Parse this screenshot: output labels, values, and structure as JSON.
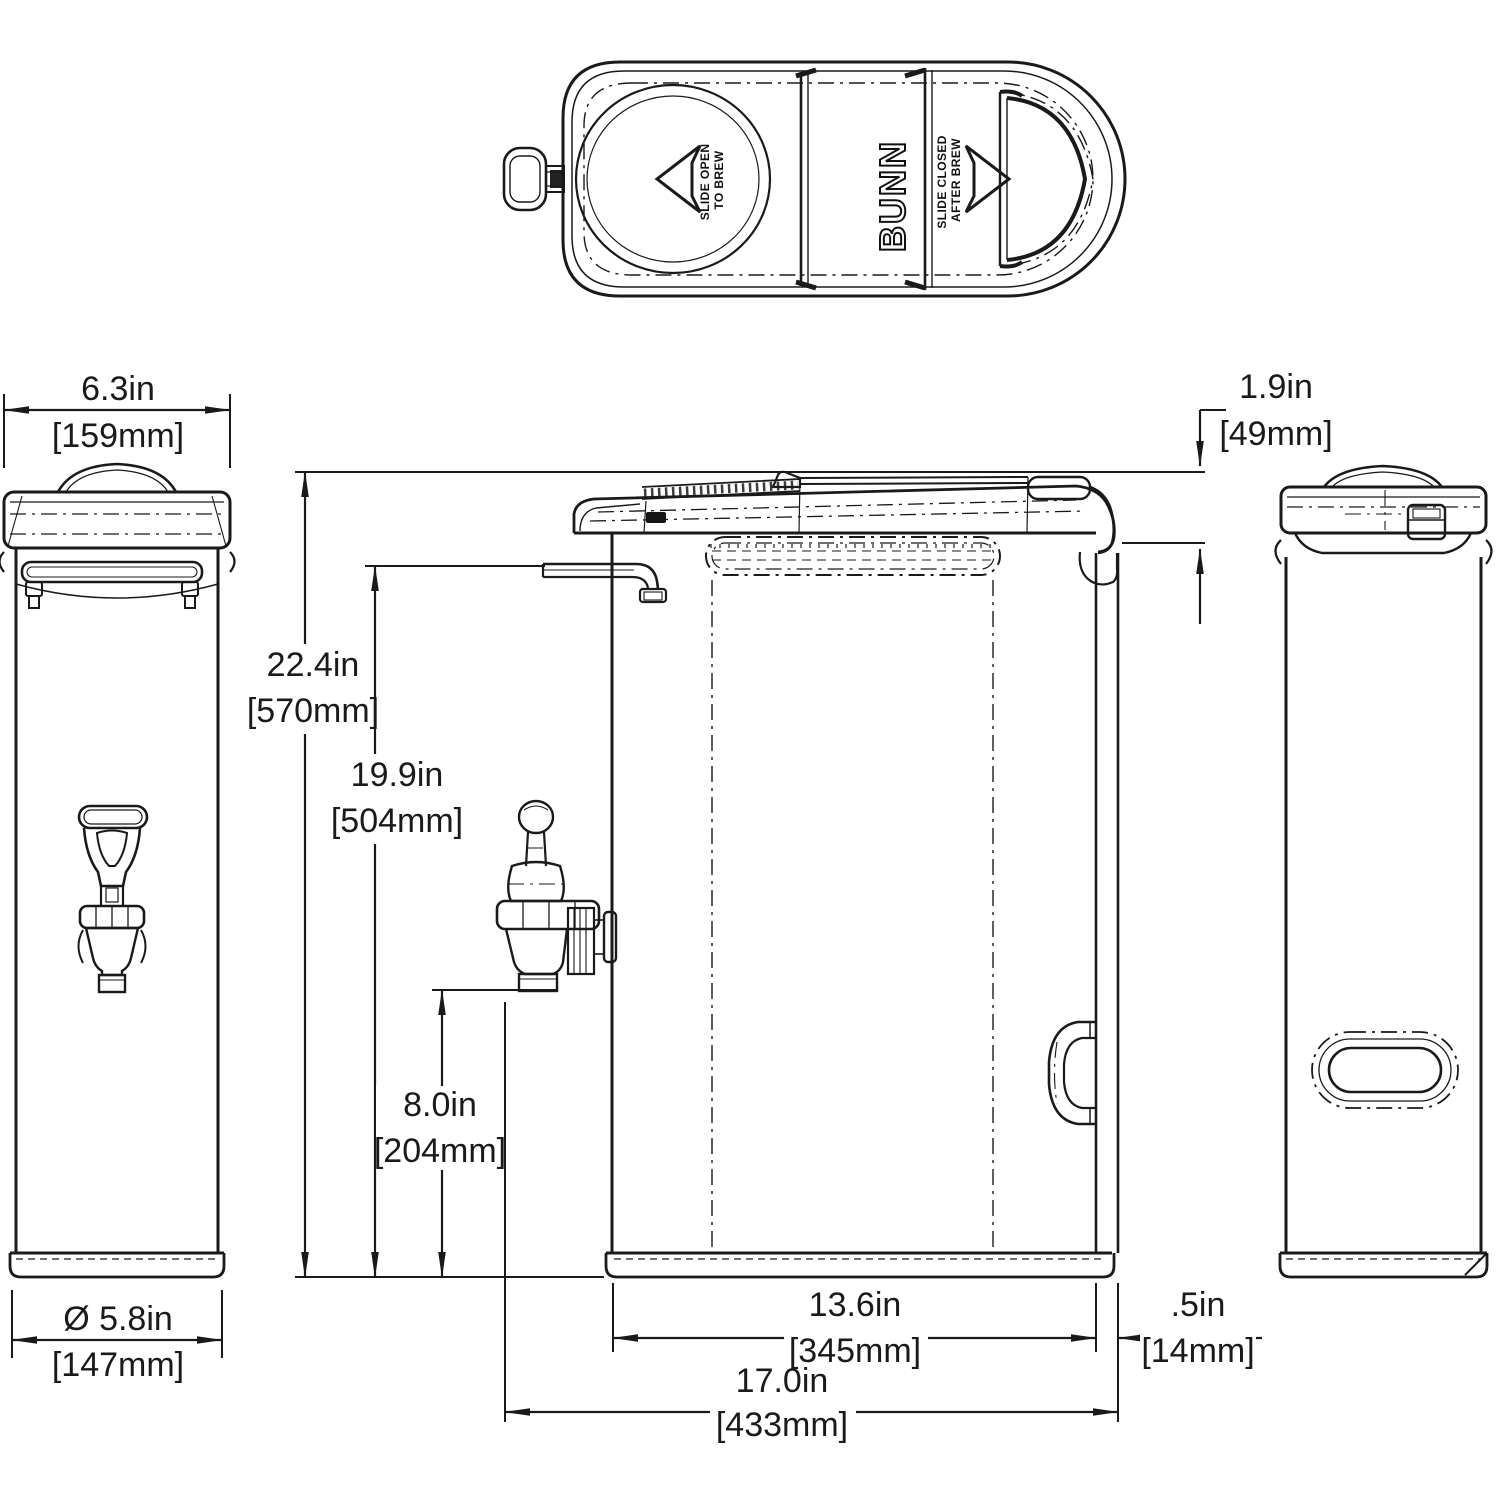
{
  "drawing": {
    "brand": "BUNN",
    "top_view": {
      "slide_open_line1": "SLIDE OPEN",
      "slide_open_line2": "TO BREW",
      "slide_closed_line1": "SLIDE CLOSED",
      "slide_closed_line2": "AFTER BREW"
    },
    "dimensions": {
      "lid_width": {
        "inches": "6.3in",
        "metric": "[159mm]"
      },
      "lid_height": {
        "inches": "1.9in",
        "metric": "[49mm]"
      },
      "overall_height": {
        "inches": "22.4in",
        "metric": "[570mm]"
      },
      "tube_height": {
        "inches": "19.9in",
        "metric": "[504mm]"
      },
      "faucet_clearance": {
        "inches": "8.0in",
        "metric": "[204mm]"
      },
      "base_diameter": {
        "inches": "Ø 5.8in",
        "metric": "[147mm]"
      },
      "body_depth": {
        "inches": "13.6in",
        "metric": "[345mm]"
      },
      "overall_depth": {
        "inches": "17.0in",
        "metric": "[433mm]"
      },
      "handle_clearance": {
        "inches": ".5in",
        "metric": "[14mm]"
      }
    },
    "line_color": "#1a1a1a"
  }
}
